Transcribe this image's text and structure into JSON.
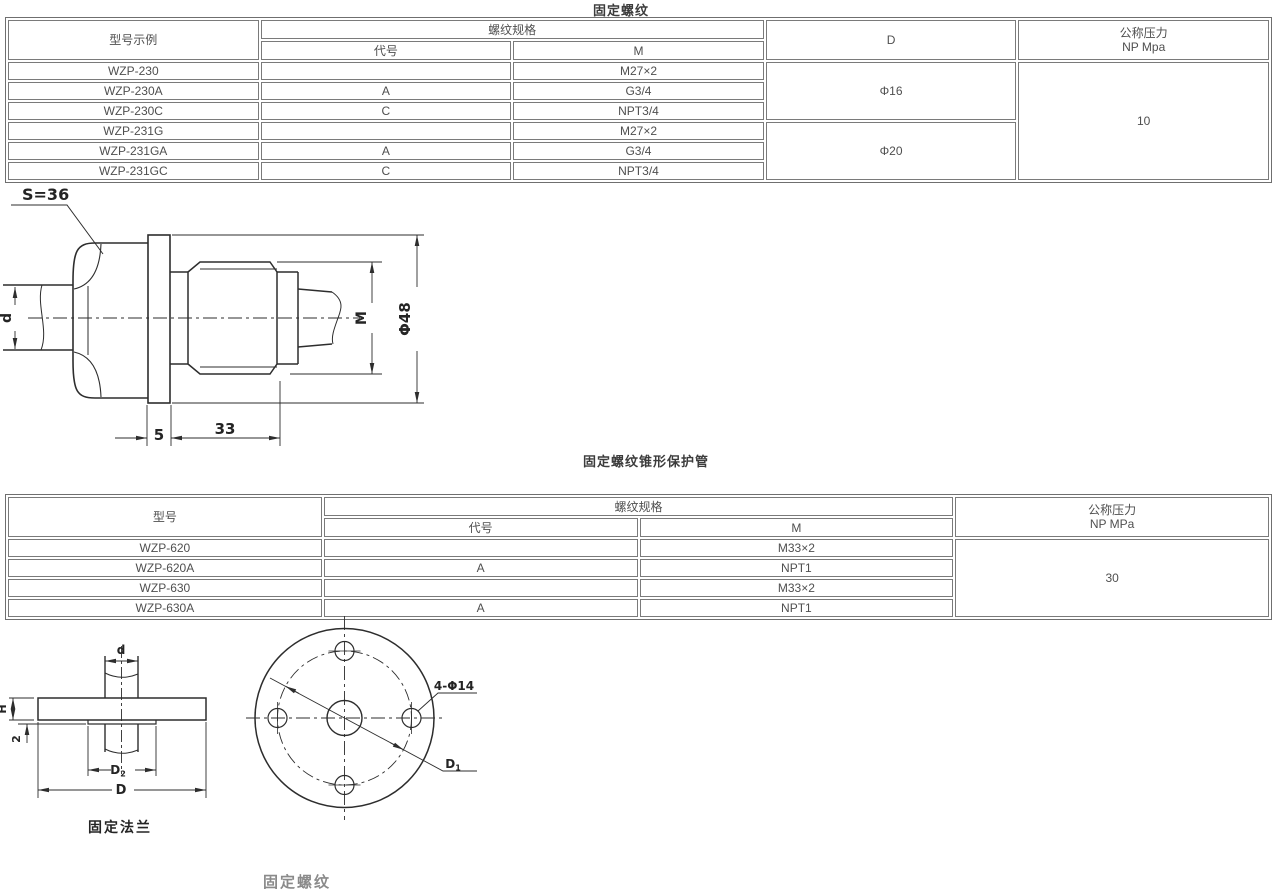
{
  "page": {
    "background": "#ffffff",
    "drawing_line_color": "#2d2d2d",
    "table_border_color": "#7a7a7a",
    "table_text_color": "#4f4f4f"
  },
  "section_fixed_thread": {
    "title": "固定螺纹",
    "table": {
      "col_model": "型号示例",
      "col_thread_spec": "螺纹规格",
      "col_code": "代号",
      "col_m": "M",
      "col_d": "D",
      "col_pressure_line1": "公称压力",
      "col_pressure_line2": "NP Mpa",
      "rows": [
        {
          "model": "WZP-230",
          "code": "",
          "m": "M27×2"
        },
        {
          "model": "WZP-230A",
          "code": "A",
          "m": "G3/4"
        },
        {
          "model": "WZP-230C",
          "code": "C",
          "m": "NPT3/4"
        },
        {
          "model": "WZP-231G",
          "code": "",
          "m": "M27×2"
        },
        {
          "model": "WZP-231GA",
          "code": "A",
          "m": "G3/4"
        },
        {
          "model": "WZP-231GC",
          "code": "C",
          "m": "NPT3/4"
        }
      ],
      "d_value_group1": "Φ16",
      "d_value_group2": "Φ20",
      "pressure_value": "10"
    },
    "drawing_labels": {
      "hex_across_flats": "S=36",
      "inlet_diameter": "d",
      "thread": "M",
      "outer_diameter": "Φ48",
      "flange_thickness": "5",
      "thread_length": "33"
    }
  },
  "section_tapered_tube": {
    "title": "固定螺纹锥形保护管",
    "table": {
      "col_model": "型号",
      "col_thread_spec": "螺纹规格",
      "col_code": "代号",
      "col_m": "M",
      "col_pressure_line1": "公称压力",
      "col_pressure_line2": "NP MPa",
      "rows": [
        {
          "model": "WZP-620",
          "code": "",
          "m": "M33×2"
        },
        {
          "model": "WZP-620A",
          "code": "A",
          "m": "NPT1"
        },
        {
          "model": "WZP-630",
          "code": "",
          "m": "M33×2"
        },
        {
          "model": "WZP-630A",
          "code": "A",
          "m": "NPT1"
        }
      ],
      "pressure_value": "30"
    }
  },
  "flange_drawing": {
    "caption": "固定法兰",
    "tube_diameter_label": "d",
    "flange_height_label": "H",
    "boss_thickness_label": "2",
    "boss_diameter_label": "D",
    "boss_diameter_sub": "2",
    "outer_diameter_label": "D",
    "bolt_holes_label": "4-Φ14",
    "bolt_circle_label": "D",
    "bolt_circle_sub": "1"
  },
  "clipped_bottom_label": "固定螺纹"
}
